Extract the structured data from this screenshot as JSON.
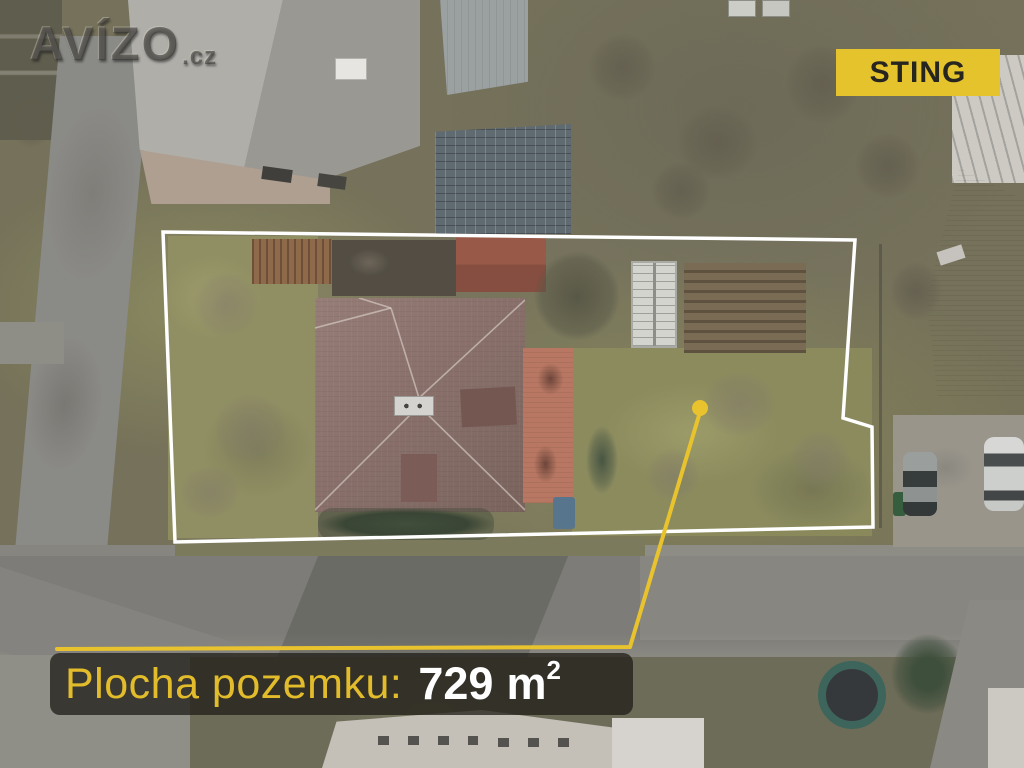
{
  "watermark": {
    "brand": "AVÍZO",
    "suffix": ".cz"
  },
  "badge": {
    "label": "STING"
  },
  "area_label": {
    "caption": "Plocha pozemku:",
    "value": "729",
    "unit": "m",
    "unit_exponent": "2"
  },
  "colors": {
    "accent_yellow": "#e9c32d",
    "boundary_white": "#ffffff",
    "badge_yellow": "#e5c32c",
    "badge_text": "#26251f",
    "label_background": "rgba(35,32,26,0.78)",
    "caption_yellow": "#e2bc2b",
    "value_white": "#ffffff"
  }
}
